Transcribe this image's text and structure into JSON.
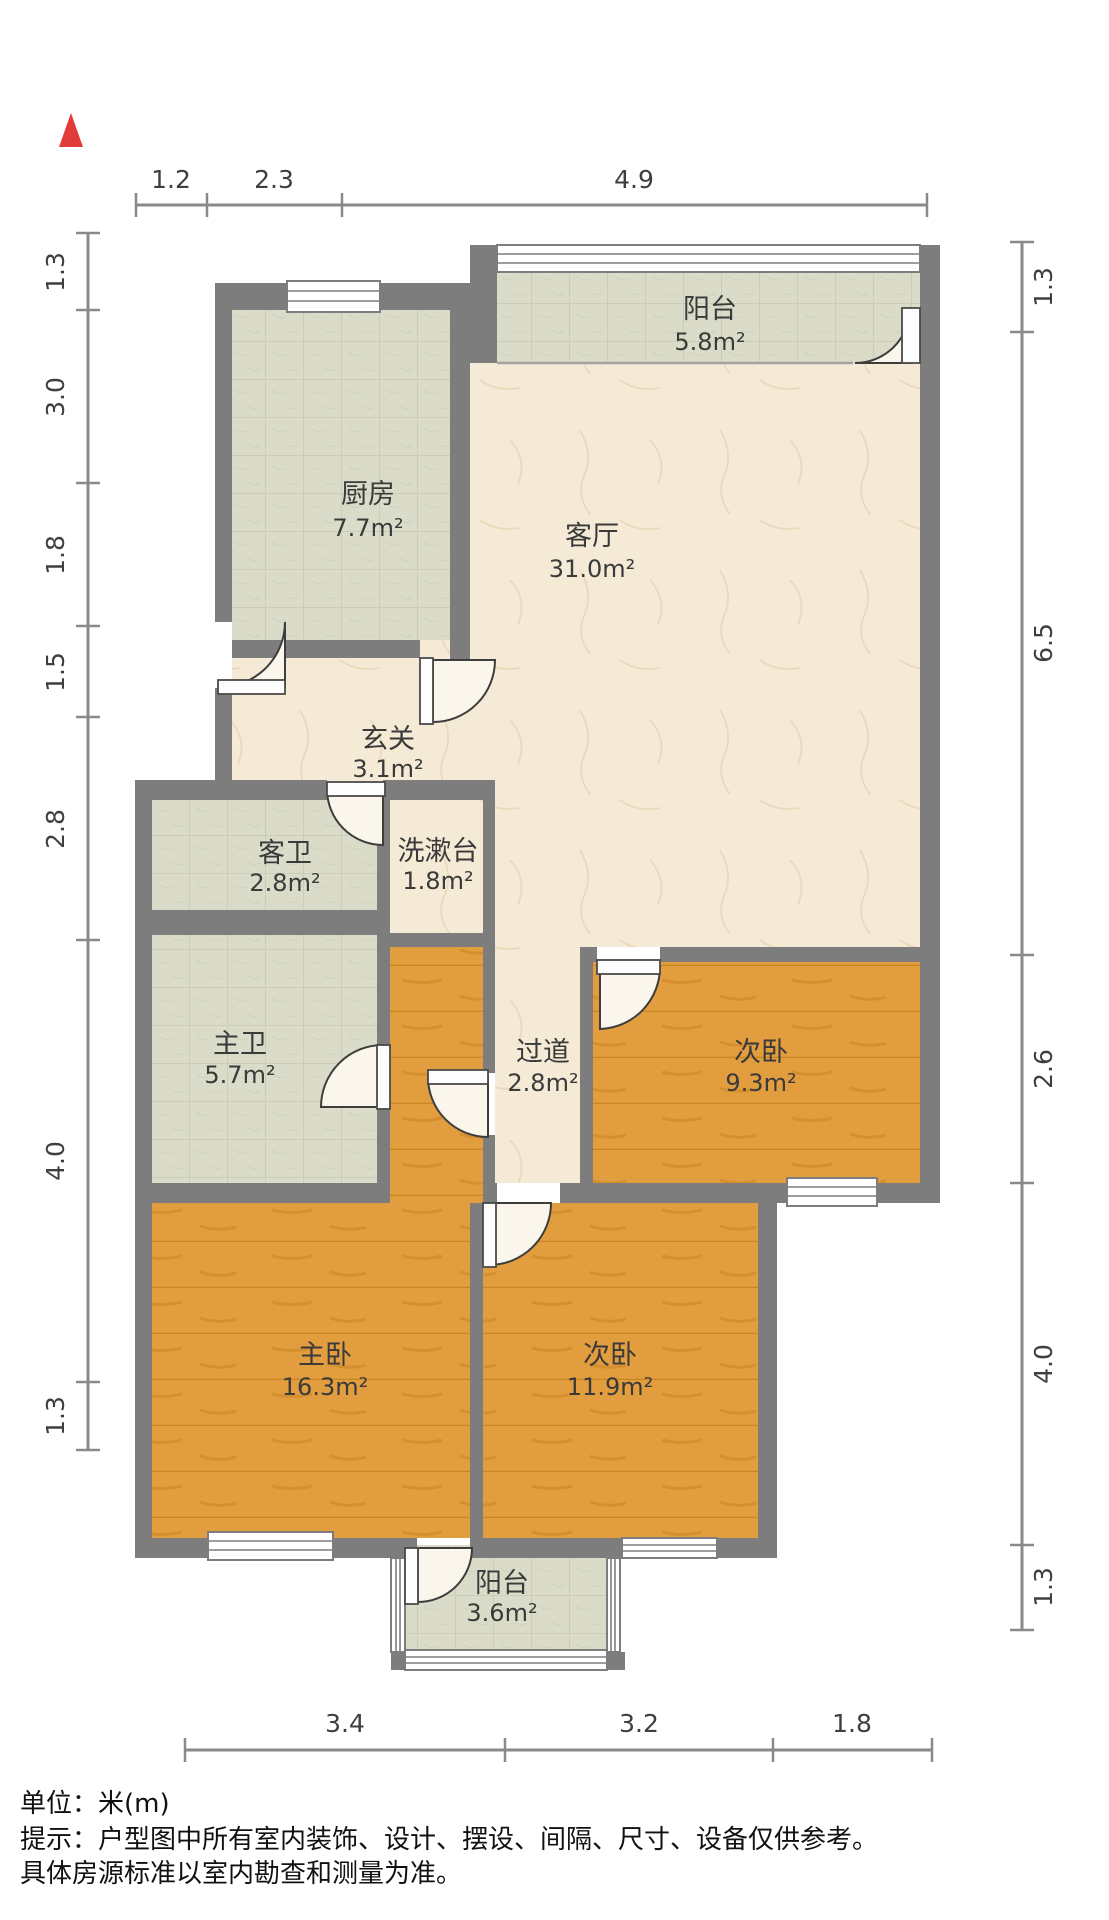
{
  "title": "户型图",
  "north_indicator": "north-arrow",
  "rooms": [
    {
      "id": "balcony-top",
      "name": "阳台",
      "area": "5.8m²"
    },
    {
      "id": "kitchen",
      "name": "厨房",
      "area": "7.7m²"
    },
    {
      "id": "living-room",
      "name": "客厅",
      "area": "31.0m²"
    },
    {
      "id": "entryway",
      "name": "玄关",
      "area": "3.1m²"
    },
    {
      "id": "guest-bathroom",
      "name": "客卫",
      "area": "2.8m²"
    },
    {
      "id": "washstand",
      "name": "洗漱台",
      "area": "1.8m²"
    },
    {
      "id": "master-bathroom",
      "name": "主卫",
      "area": "5.7m²"
    },
    {
      "id": "hallway",
      "name": "过道",
      "area": "2.8m²"
    },
    {
      "id": "second-bedroom-top",
      "name": "次卧",
      "area": "9.3m²"
    },
    {
      "id": "master-bedroom",
      "name": "主卧",
      "area": "16.3m²"
    },
    {
      "id": "second-bedroom-bottom",
      "name": "次卧",
      "area": "11.9m²"
    },
    {
      "id": "balcony-bottom",
      "name": "阳台",
      "area": "3.6m²"
    }
  ],
  "dimensions": {
    "top": [
      "1.2",
      "2.3",
      "4.9"
    ],
    "left": [
      "1.3",
      "3.0",
      "1.8",
      "1.5",
      "2.8",
      "4.0",
      "1.3"
    ],
    "right": [
      "1.3",
      "6.5",
      "2.6",
      "4.0",
      "1.3"
    ],
    "bottom": [
      "3.4",
      "3.2",
      "1.8"
    ]
  },
  "footer": {
    "unit_line": "单位：米(m)",
    "tip_line1": "提示：户型图中所有室内装饰、设计、摆设、间隔、尺寸、设备仅供参考。",
    "tip_line2": "具体房源标准以室内勘查和测量为准。"
  },
  "colors": {
    "wall": "#7d7d7d",
    "wood_floor": "#e29d3e",
    "tile_floor": "#dadcc9",
    "marble_floor": "#f4ead6",
    "north_arrow": "#e23b3b",
    "text": "#3a3a3a"
  }
}
